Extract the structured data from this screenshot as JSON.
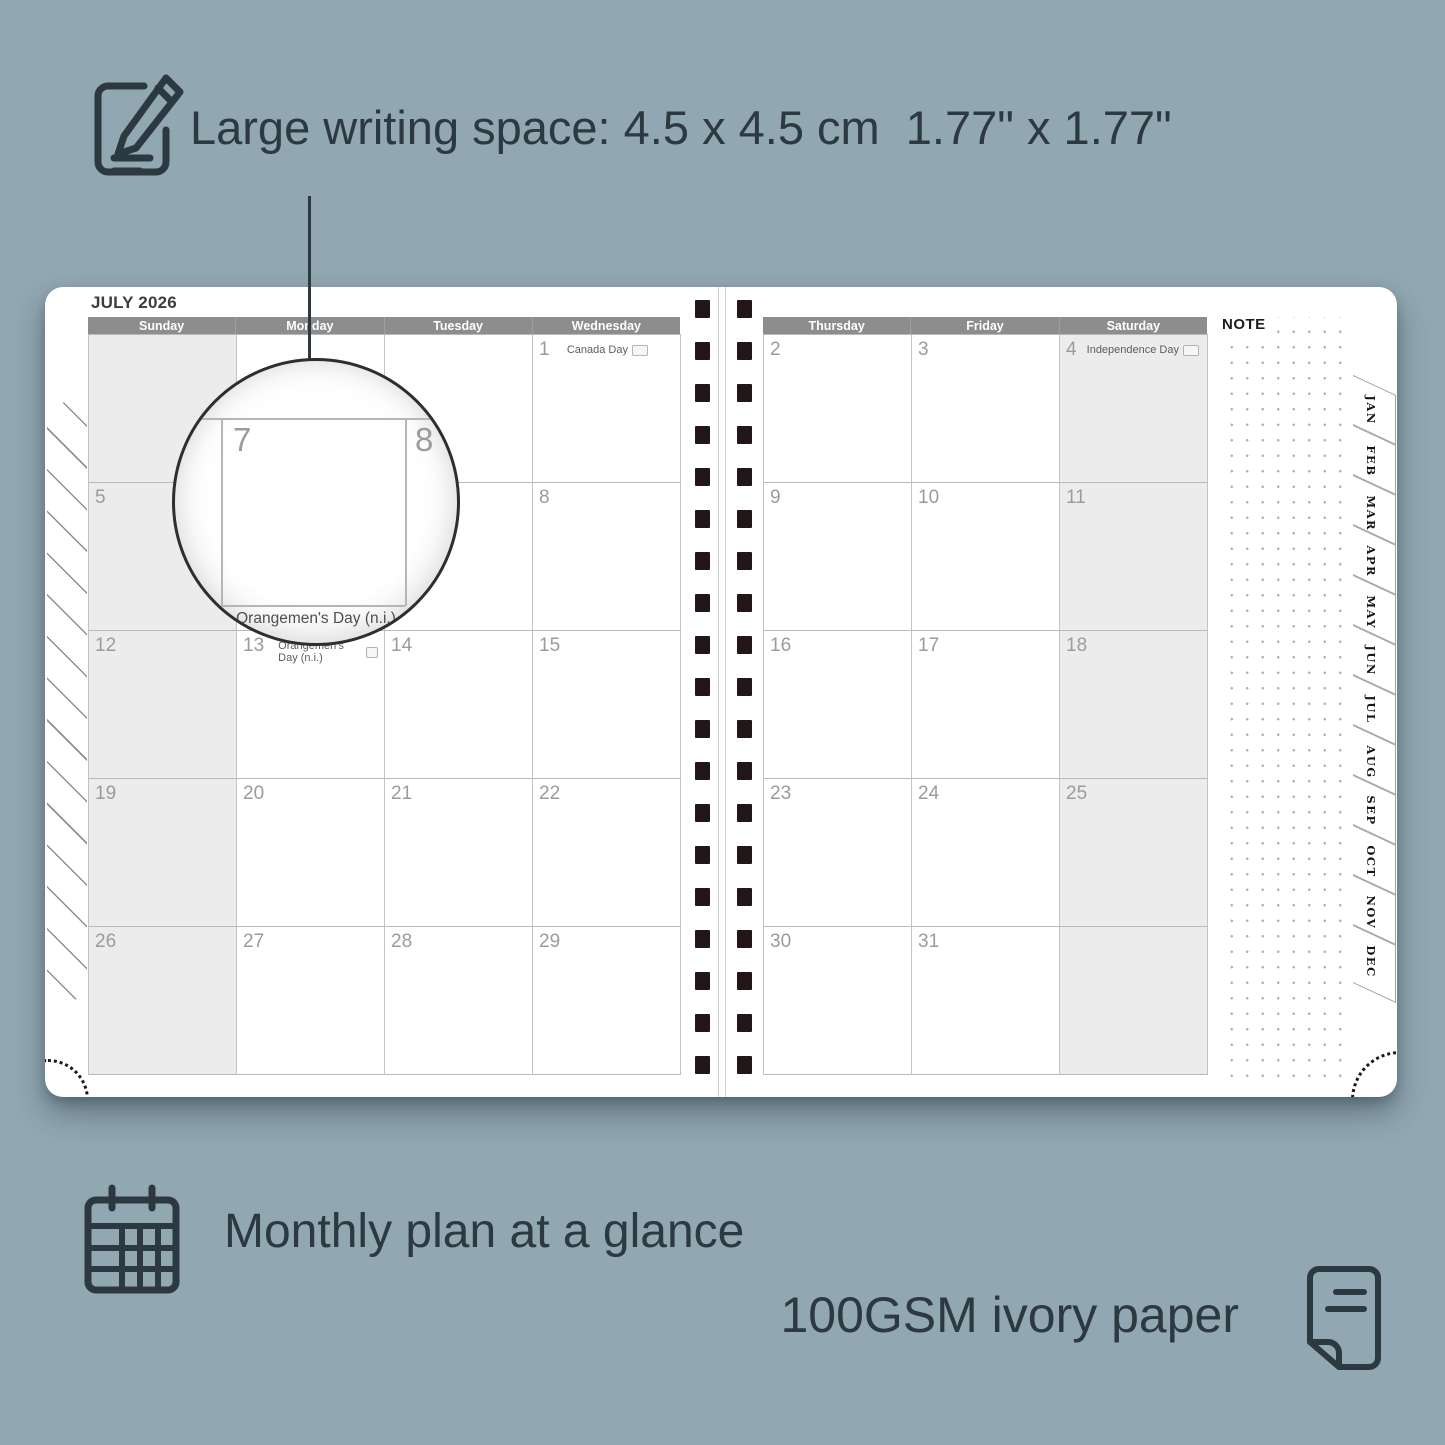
{
  "colors": {
    "background": "#91a7b1",
    "ink": "#2c3940",
    "header_bar": "#8d8d8d",
    "shaded_cell": "#ececec",
    "binding_hole": "#221619",
    "page": "#ffffff"
  },
  "annotations": {
    "top": {
      "icon": "pencil-note-icon",
      "text": "Large writing space: 4.5 x 4.5 cm  1.77\" x 1.77\""
    },
    "monthly": {
      "icon": "calendar-grid-icon",
      "text": "Monthly plan at a glance"
    },
    "paper": {
      "icon": "paper-sheet-icon",
      "text": "100GSM ivory paper"
    }
  },
  "planner": {
    "month_title": "JULY 2026",
    "note_label": "NOTE",
    "left_page": {
      "day_headers": [
        "Sunday",
        "Monday",
        "Tuesday",
        "Wednesday"
      ],
      "rows": [
        [
          {
            "day": "",
            "shaded": true
          },
          {
            "day": ""
          },
          {
            "day": ""
          },
          {
            "day": "1",
            "holiday": "Canada Day",
            "flag": true,
            "holiday_align": "right",
            "pad": 26
          }
        ],
        [
          {
            "day": "5",
            "shaded": true
          },
          {
            "day": "6"
          },
          {
            "day": "7"
          },
          {
            "day": "8"
          }
        ],
        [
          {
            "day": "12",
            "shaded": true
          },
          {
            "day": "13",
            "holiday": "Orangemen's Day (n.i.)",
            "flag": true,
            "holiday_align": "left"
          },
          {
            "day": "14"
          },
          {
            "day": "15"
          }
        ],
        [
          {
            "day": "19",
            "shaded": true
          },
          {
            "day": "20"
          },
          {
            "day": "21"
          },
          {
            "day": "22"
          }
        ],
        [
          {
            "day": "26",
            "shaded": true
          },
          {
            "day": "27"
          },
          {
            "day": "28"
          },
          {
            "day": "29"
          }
        ]
      ]
    },
    "right_page": {
      "day_headers": [
        "Thursday",
        "Friday",
        "Saturday"
      ],
      "rows": [
        [
          {
            "day": "2"
          },
          {
            "day": "3"
          },
          {
            "day": "4",
            "holiday": "Independence Day",
            "flag": true,
            "holiday_align": "right",
            "pad": 2,
            "shaded": true
          }
        ],
        [
          {
            "day": "9"
          },
          {
            "day": "10"
          },
          {
            "day": "11",
            "shaded": true
          }
        ],
        [
          {
            "day": "16"
          },
          {
            "day": "17"
          },
          {
            "day": "18",
            "shaded": true
          }
        ],
        [
          {
            "day": "23"
          },
          {
            "day": "24"
          },
          {
            "day": "25",
            "shaded": true
          }
        ],
        [
          {
            "day": "30"
          },
          {
            "day": "31"
          },
          {
            "day": "",
            "shaded": true
          }
        ]
      ]
    },
    "magnifier": {
      "day_left": "7",
      "day_right": "8",
      "caption": "Orangemen's Day (n.i.)"
    },
    "tabs": [
      "JAN",
      "FEB",
      "MAR",
      "APR",
      "MAY",
      "JUN",
      "JUL",
      "AUG",
      "SEP",
      "OCT",
      "NOV",
      "DEC"
    ],
    "binding": {
      "columns": 2,
      "holes_per_column": 19
    }
  }
}
